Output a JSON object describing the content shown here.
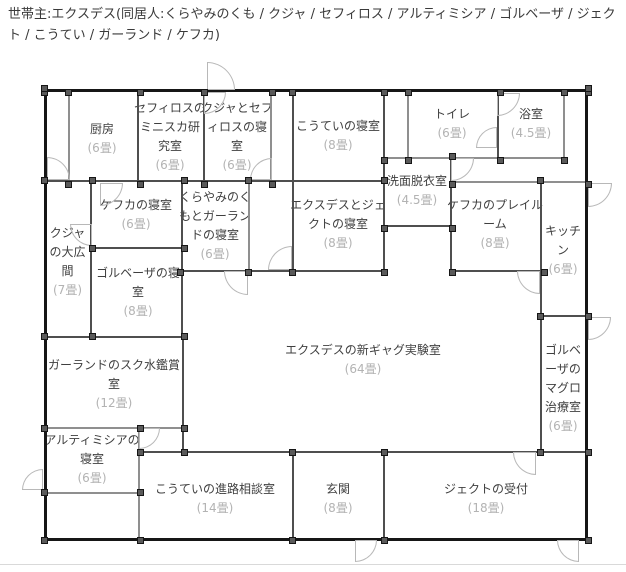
{
  "header": {
    "text": "世帯主:エクスデス(同居人:くらやみのくも / クジャ / セフィロス / アルティミシア / ゴルベーザ / ジェクト / こうてい / ガーランド / ケフカ)"
  },
  "floorplan": {
    "rooms": [
      {
        "name": "厨房",
        "size": "(6畳)"
      },
      {
        "name": "セフィロスの\nミニスカ研\n究室",
        "size": "(6畳)"
      },
      {
        "name": "クジャとセフ\nィロスの寝\n室",
        "size": "(6畳)"
      },
      {
        "name": "こうていの寝室",
        "size": "(8畳)"
      },
      {
        "name": "トイレ",
        "size": "(6畳)"
      },
      {
        "name": "浴室",
        "size": "(4.5畳)"
      },
      {
        "name": "洗面脱衣室",
        "size": "(4.5畳)"
      },
      {
        "name": "ケフカの寝室",
        "size": "(6畳)"
      },
      {
        "name": "くらやみのく\nもとガーラン\nドの寝室",
        "size": "(6畳)"
      },
      {
        "name": "エクスデスとジェ\nクトの寝室",
        "size": "(8畳)"
      },
      {
        "name": "ケフカのプレイル\nーム",
        "size": "(8畳)"
      },
      {
        "name": "キッチ\nン",
        "size": "(6畳)"
      },
      {
        "name": "クジャ\nの大広\n間",
        "size": "(7畳)"
      },
      {
        "name": "ゴルベーザの寝\n室",
        "size": "(8畳)"
      },
      {
        "name": "ガーランドのスク水鑑賞\n室",
        "size": "(12畳)"
      },
      {
        "name": "アルティミシアの\n寝室",
        "size": "(6畳)"
      },
      {
        "name": "こうていの進路相談室",
        "size": "(14畳)"
      },
      {
        "name": "玄関",
        "size": "(8畳)"
      },
      {
        "name": "ジェクトの受付",
        "size": "(18畳)"
      },
      {
        "name": "エクスデスの新ギャグ実験室",
        "size": "(64畳)"
      },
      {
        "name": "ゴルベ\nーザの\nマグロ\n治療室",
        "size": "(6畳)"
      }
    ]
  }
}
